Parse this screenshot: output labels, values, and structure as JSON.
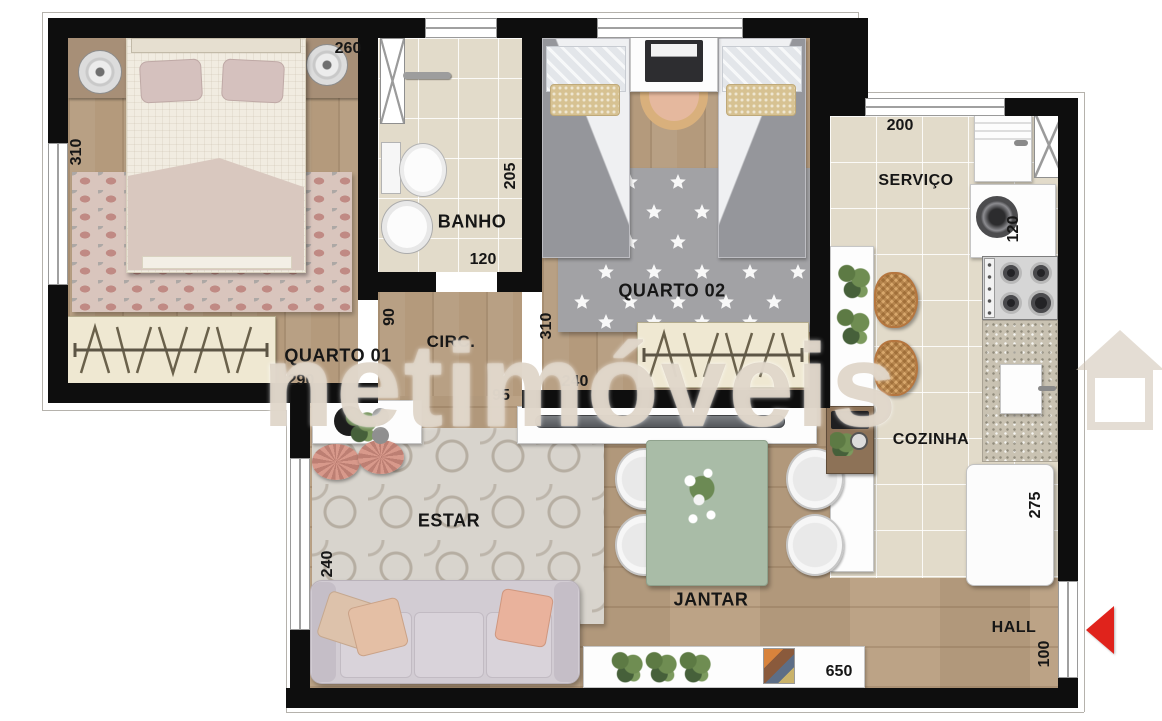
{
  "watermark": {
    "text": "netimóveis"
  },
  "labels": {
    "quarto01": "QUARTO 01",
    "quarto02": "QUARTO 02",
    "banho": "BANHO",
    "circ": "CIRC.",
    "servico": "SERVIÇO",
    "cozinha": "COZINHA",
    "estar": "ESTAR",
    "jantar": "JANTAR",
    "hall": "HALL"
  },
  "dimensions": {
    "quarto01_width": "260",
    "quarto01_depth": "310",
    "quarto01_wardrobe": "290",
    "banho_depth": "205",
    "banho_width": "120",
    "circ_width": "90",
    "circ_passage": "95",
    "quarto02_depth": "310",
    "quarto02_wardrobe": "240",
    "servico_width": "200",
    "washer_width": "120",
    "fridge_width": "275",
    "estar_window": "240",
    "hall_width": "100",
    "living_width": "650"
  },
  "colors": {
    "entrance_arrow": "#e0231c",
    "wall": "#0e0e0e"
  }
}
